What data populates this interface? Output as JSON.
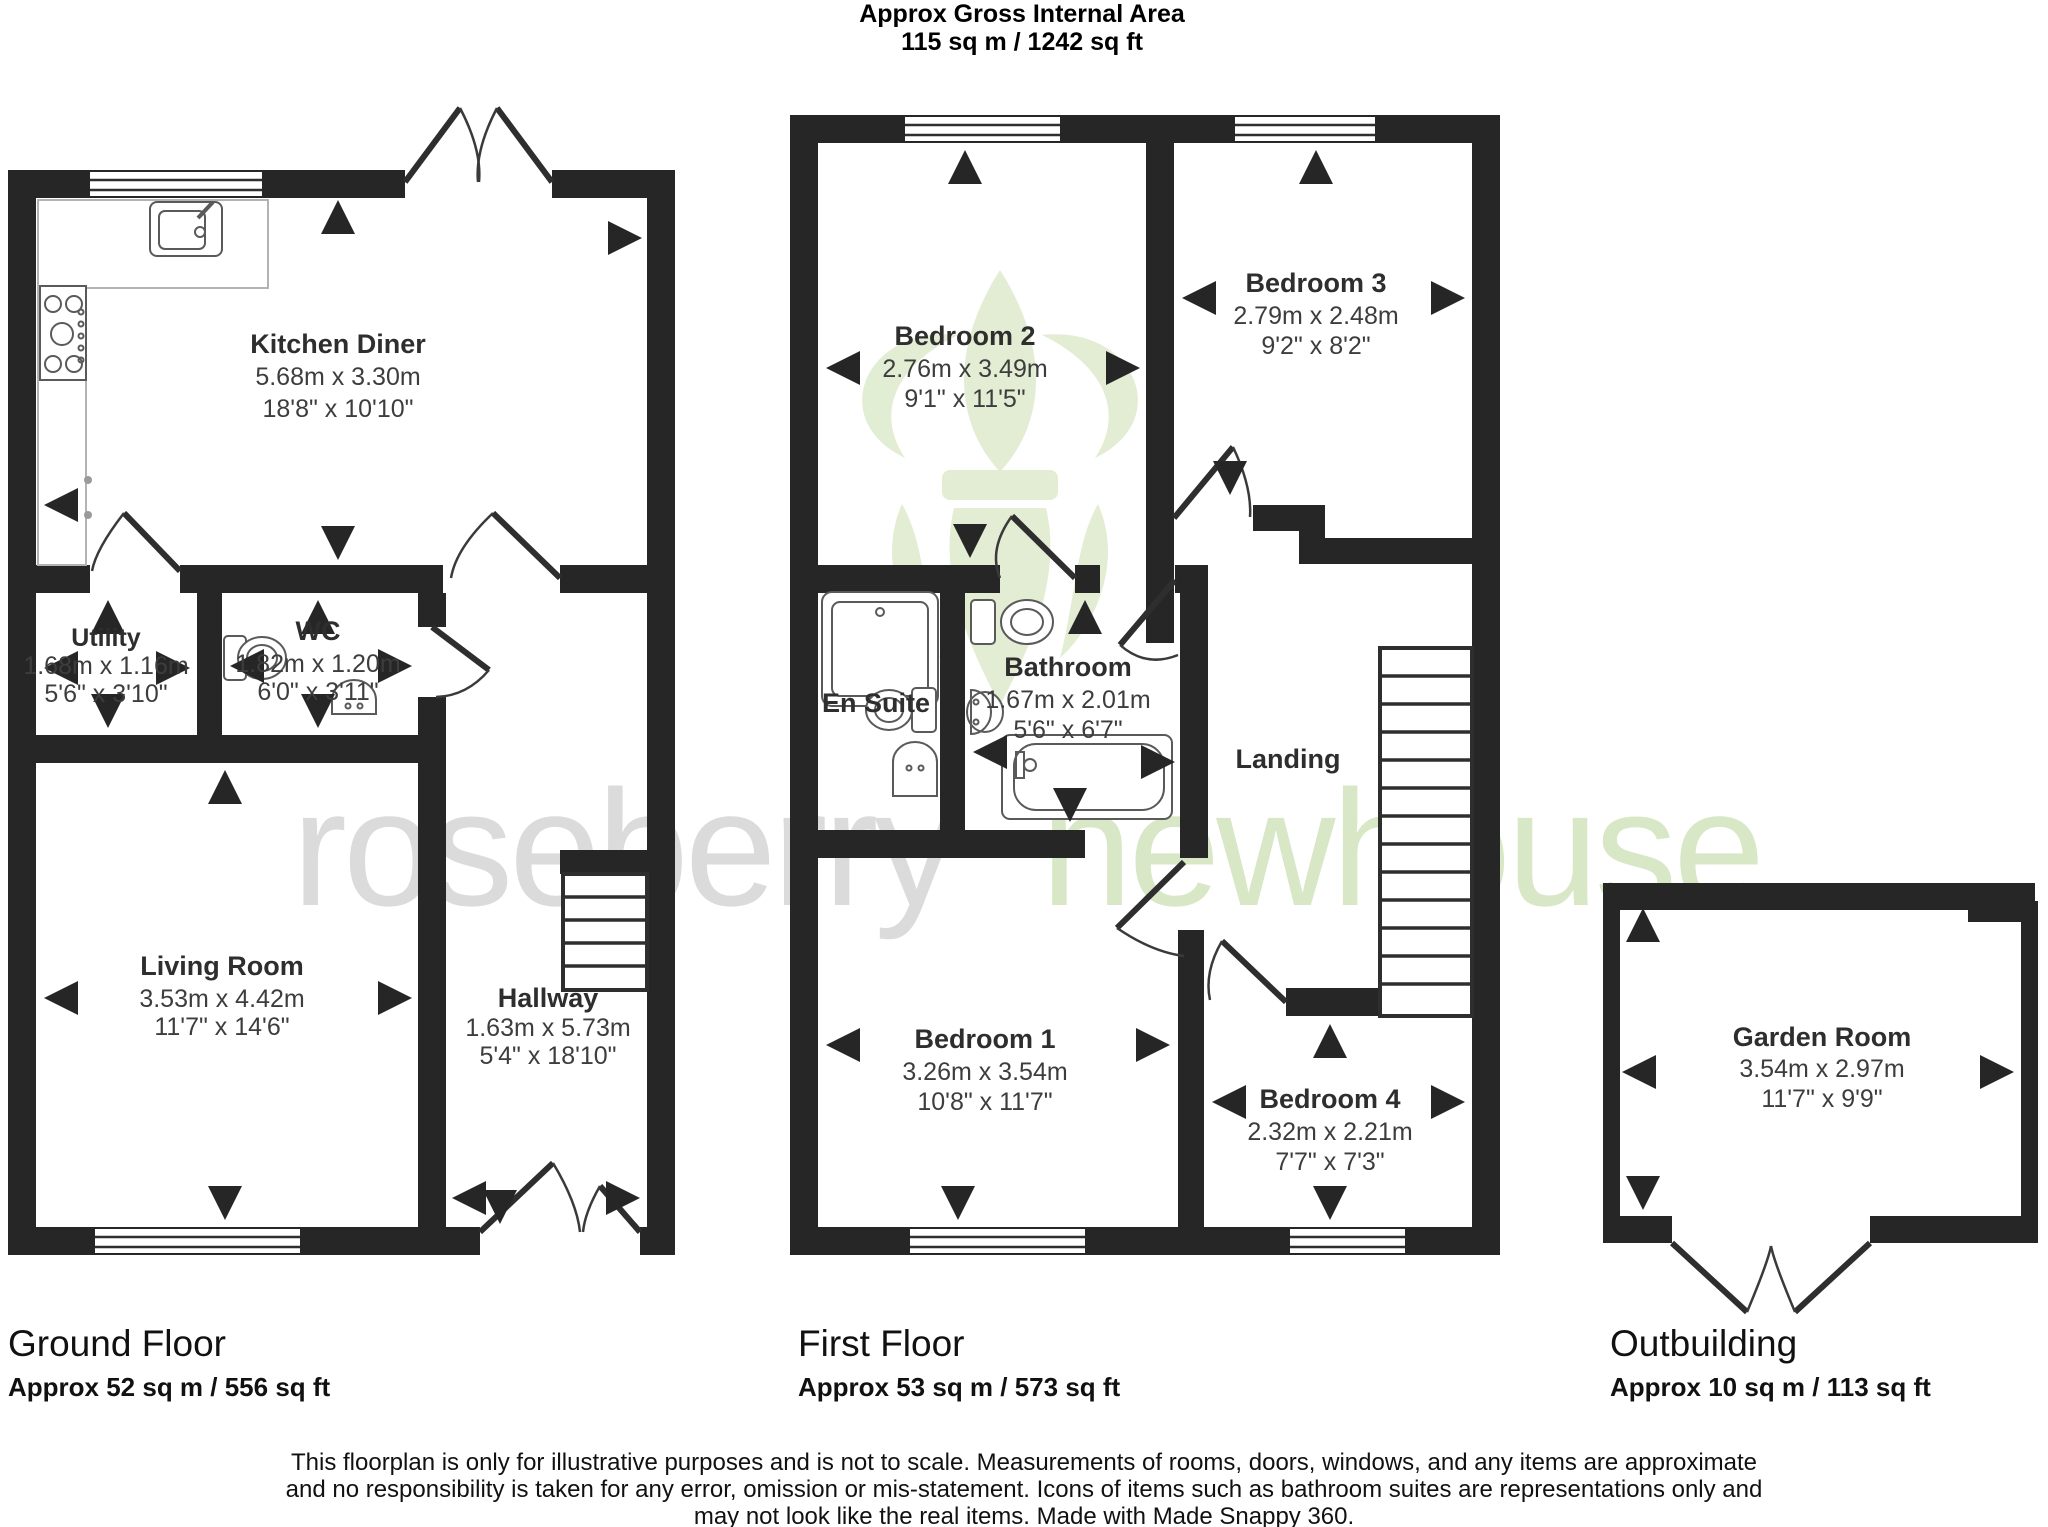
{
  "title": {
    "line1": "Approx Gross Internal Area",
    "line2": "115 sq m / 1242 sq ft"
  },
  "watermark": {
    "brand1": "roseberry",
    "brand2": "newhouse",
    "gray": "#c6c6c6",
    "green": "#cfe2b8"
  },
  "rooms": {
    "kitchen": {
      "name": "Kitchen Diner",
      "metric": "5.68m x 3.30m",
      "imperial": "18'8\" x 10'10\""
    },
    "utility": {
      "name": "Utility",
      "metric": "1.68m x 1.16m",
      "imperial": "5'6\" x 3'10\""
    },
    "wc": {
      "name": "WC",
      "metric": "1.82m x 1.20m",
      "imperial": "6'0\" x 3'11\""
    },
    "living": {
      "name": "Living Room",
      "metric": "3.53m x 4.42m",
      "imperial": "11'7\" x 14'6\""
    },
    "hallway": {
      "name": "Hallway",
      "metric": "1.63m x 5.73m",
      "imperial": "5'4\" x 18'10\""
    },
    "bedroom2": {
      "name": "Bedroom 2",
      "metric": "2.76m x 3.49m",
      "imperial": "9'1\" x 11'5\""
    },
    "bedroom3": {
      "name": "Bedroom 3",
      "metric": "2.79m x 2.48m",
      "imperial": "9'2\" x 8'2\""
    },
    "ensuite": {
      "name": "En Suite"
    },
    "bathroom": {
      "name": "Bathroom",
      "metric": "1.67m x 2.01m",
      "imperial": "5'6\" x 6'7\""
    },
    "landing": {
      "name": "Landing"
    },
    "bedroom1": {
      "name": "Bedroom 1",
      "metric": "3.26m x 3.54m",
      "imperial": "10'8\" x 11'7\""
    },
    "bedroom4": {
      "name": "Bedroom 4",
      "metric": "2.32m x 2.21m",
      "imperial": "7'7\" x 7'3\""
    },
    "garden": {
      "name": "Garden Room",
      "metric": "3.54m x 2.97m",
      "imperial": "11'7\" x 9'9\""
    }
  },
  "floors": {
    "ground": {
      "label": "Ground Floor",
      "area": "Approx 52 sq m / 556 sq ft"
    },
    "first": {
      "label": "First Floor",
      "area": "Approx 53 sq m / 573 sq ft"
    },
    "outbuilding": {
      "label": "Outbuilding",
      "area": "Approx 10 sq m / 113 sq ft"
    }
  },
  "disclaimer": {
    "line1": "This floorplan is only for illustrative purposes and is not to scale. Measurements of rooms, doors, windows, and any items are approximate",
    "line2": "and no responsibility is taken for any error, omission or mis-statement. Icons of items such as bathroom suites are representations only and",
    "line3": "may not look like the real items. Made with Made Snappy 360."
  }
}
